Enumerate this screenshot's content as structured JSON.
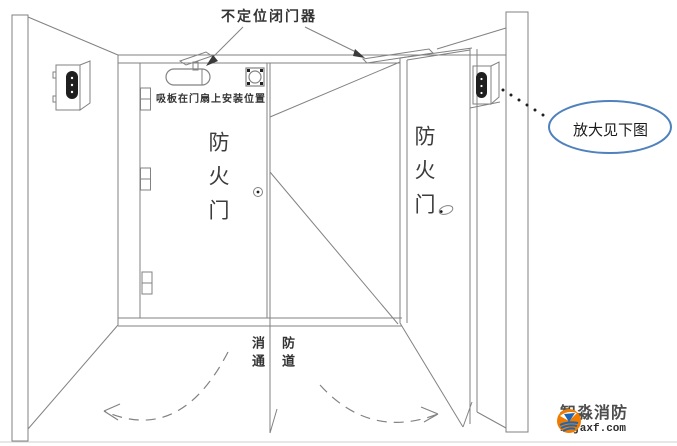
{
  "figure": {
    "annotations": {
      "door_closer_label": "不定位闭门器",
      "suction_plate_label": "吸板在门扇上安装位置",
      "left_door_label": "防火门",
      "right_door_label": "防火门",
      "passage_left_column": "消通",
      "passage_right_column": "防道",
      "callout_label": "放大见下图"
    },
    "logo": {
      "name": "智淼消防",
      "site": "zmjaxf.com"
    },
    "colors": {
      "line": "#828282",
      "text": "#333333",
      "callout_blue": "#4f81bd",
      "logo_orange": "#ef7b00",
      "logo_blue": "#1c66b3",
      "logo_text": "#4d4d4d",
      "logo_url": "#2f2f2f"
    }
  }
}
